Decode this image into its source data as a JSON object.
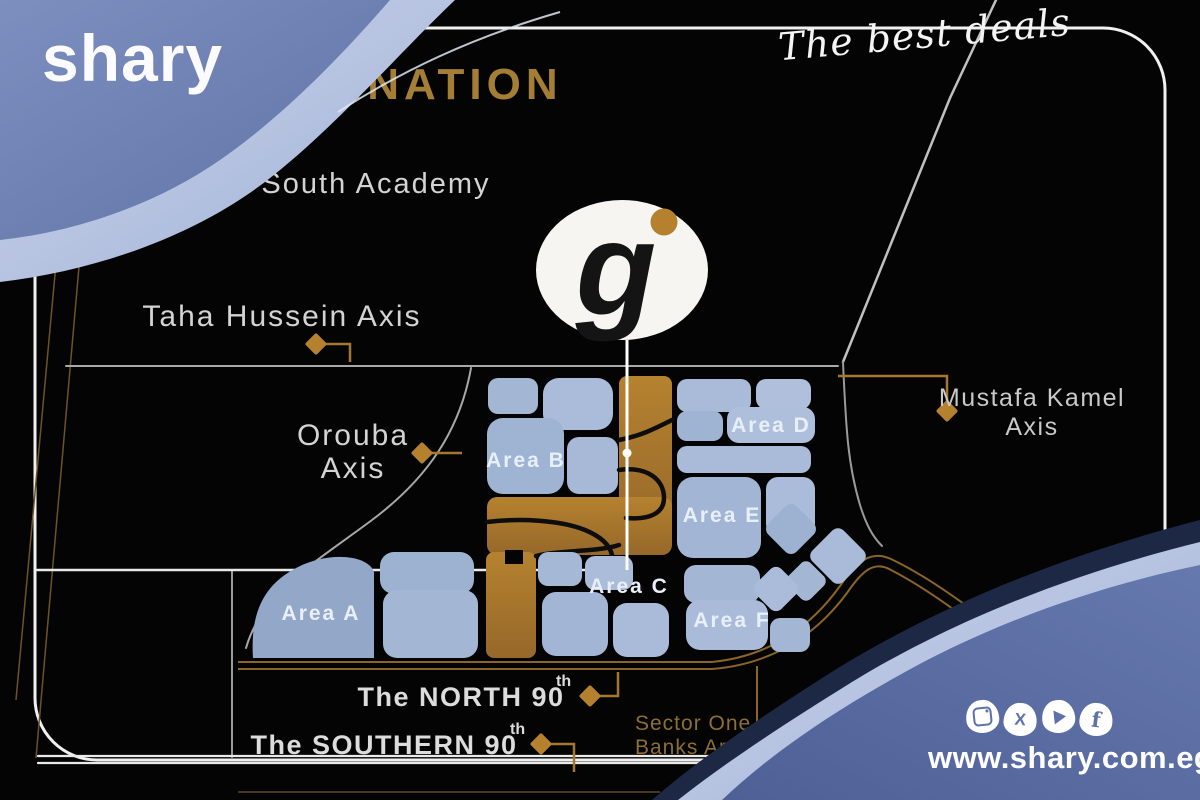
{
  "brand": {
    "logo": "shary",
    "tagline": "The best deals",
    "website": "www.shary.com.eg"
  },
  "social": {
    "glyphs": {
      "x": "X",
      "facebook": "f"
    },
    "names": [
      "instagram",
      "x",
      "youtube",
      "facebook"
    ]
  },
  "map": {
    "top_banner": "INATION",
    "landmarks": {
      "south_academy": "South Academy",
      "pet": "Pet"
    },
    "axes": {
      "taha": {
        "label": "Taha Hussein Axis"
      },
      "orouba": {
        "line1": "Orouba",
        "line2": "Axis"
      },
      "mustafa": {
        "line1": "Mustafa Kamel",
        "line2": "Axis"
      }
    },
    "roads": {
      "north90": {
        "label": "The NORTH 90",
        "sup": "th"
      },
      "southern90": {
        "label": "The SOUTHERN 90",
        "sup": "th"
      }
    },
    "sector": {
      "line1": "Sector One",
      "line2": "Banks Area"
    },
    "areas": {
      "a": "Area A",
      "b": "Area B",
      "c": "Area C",
      "d": "Area D",
      "e": "Area E",
      "f": "Area F"
    },
    "pin": {
      "letter": "g"
    }
  },
  "colors": {
    "background": "#040404",
    "frame": "#f0f0f0",
    "gold_road": "#8a6527",
    "gold_fill": "#aa782c",
    "gold_text": "#a57e36",
    "parcel_blue": "#a9bbd8",
    "wave_blue": "#5e71a9",
    "wave_light": "#aebcdf",
    "label_gray": "#d3d3d3"
  }
}
